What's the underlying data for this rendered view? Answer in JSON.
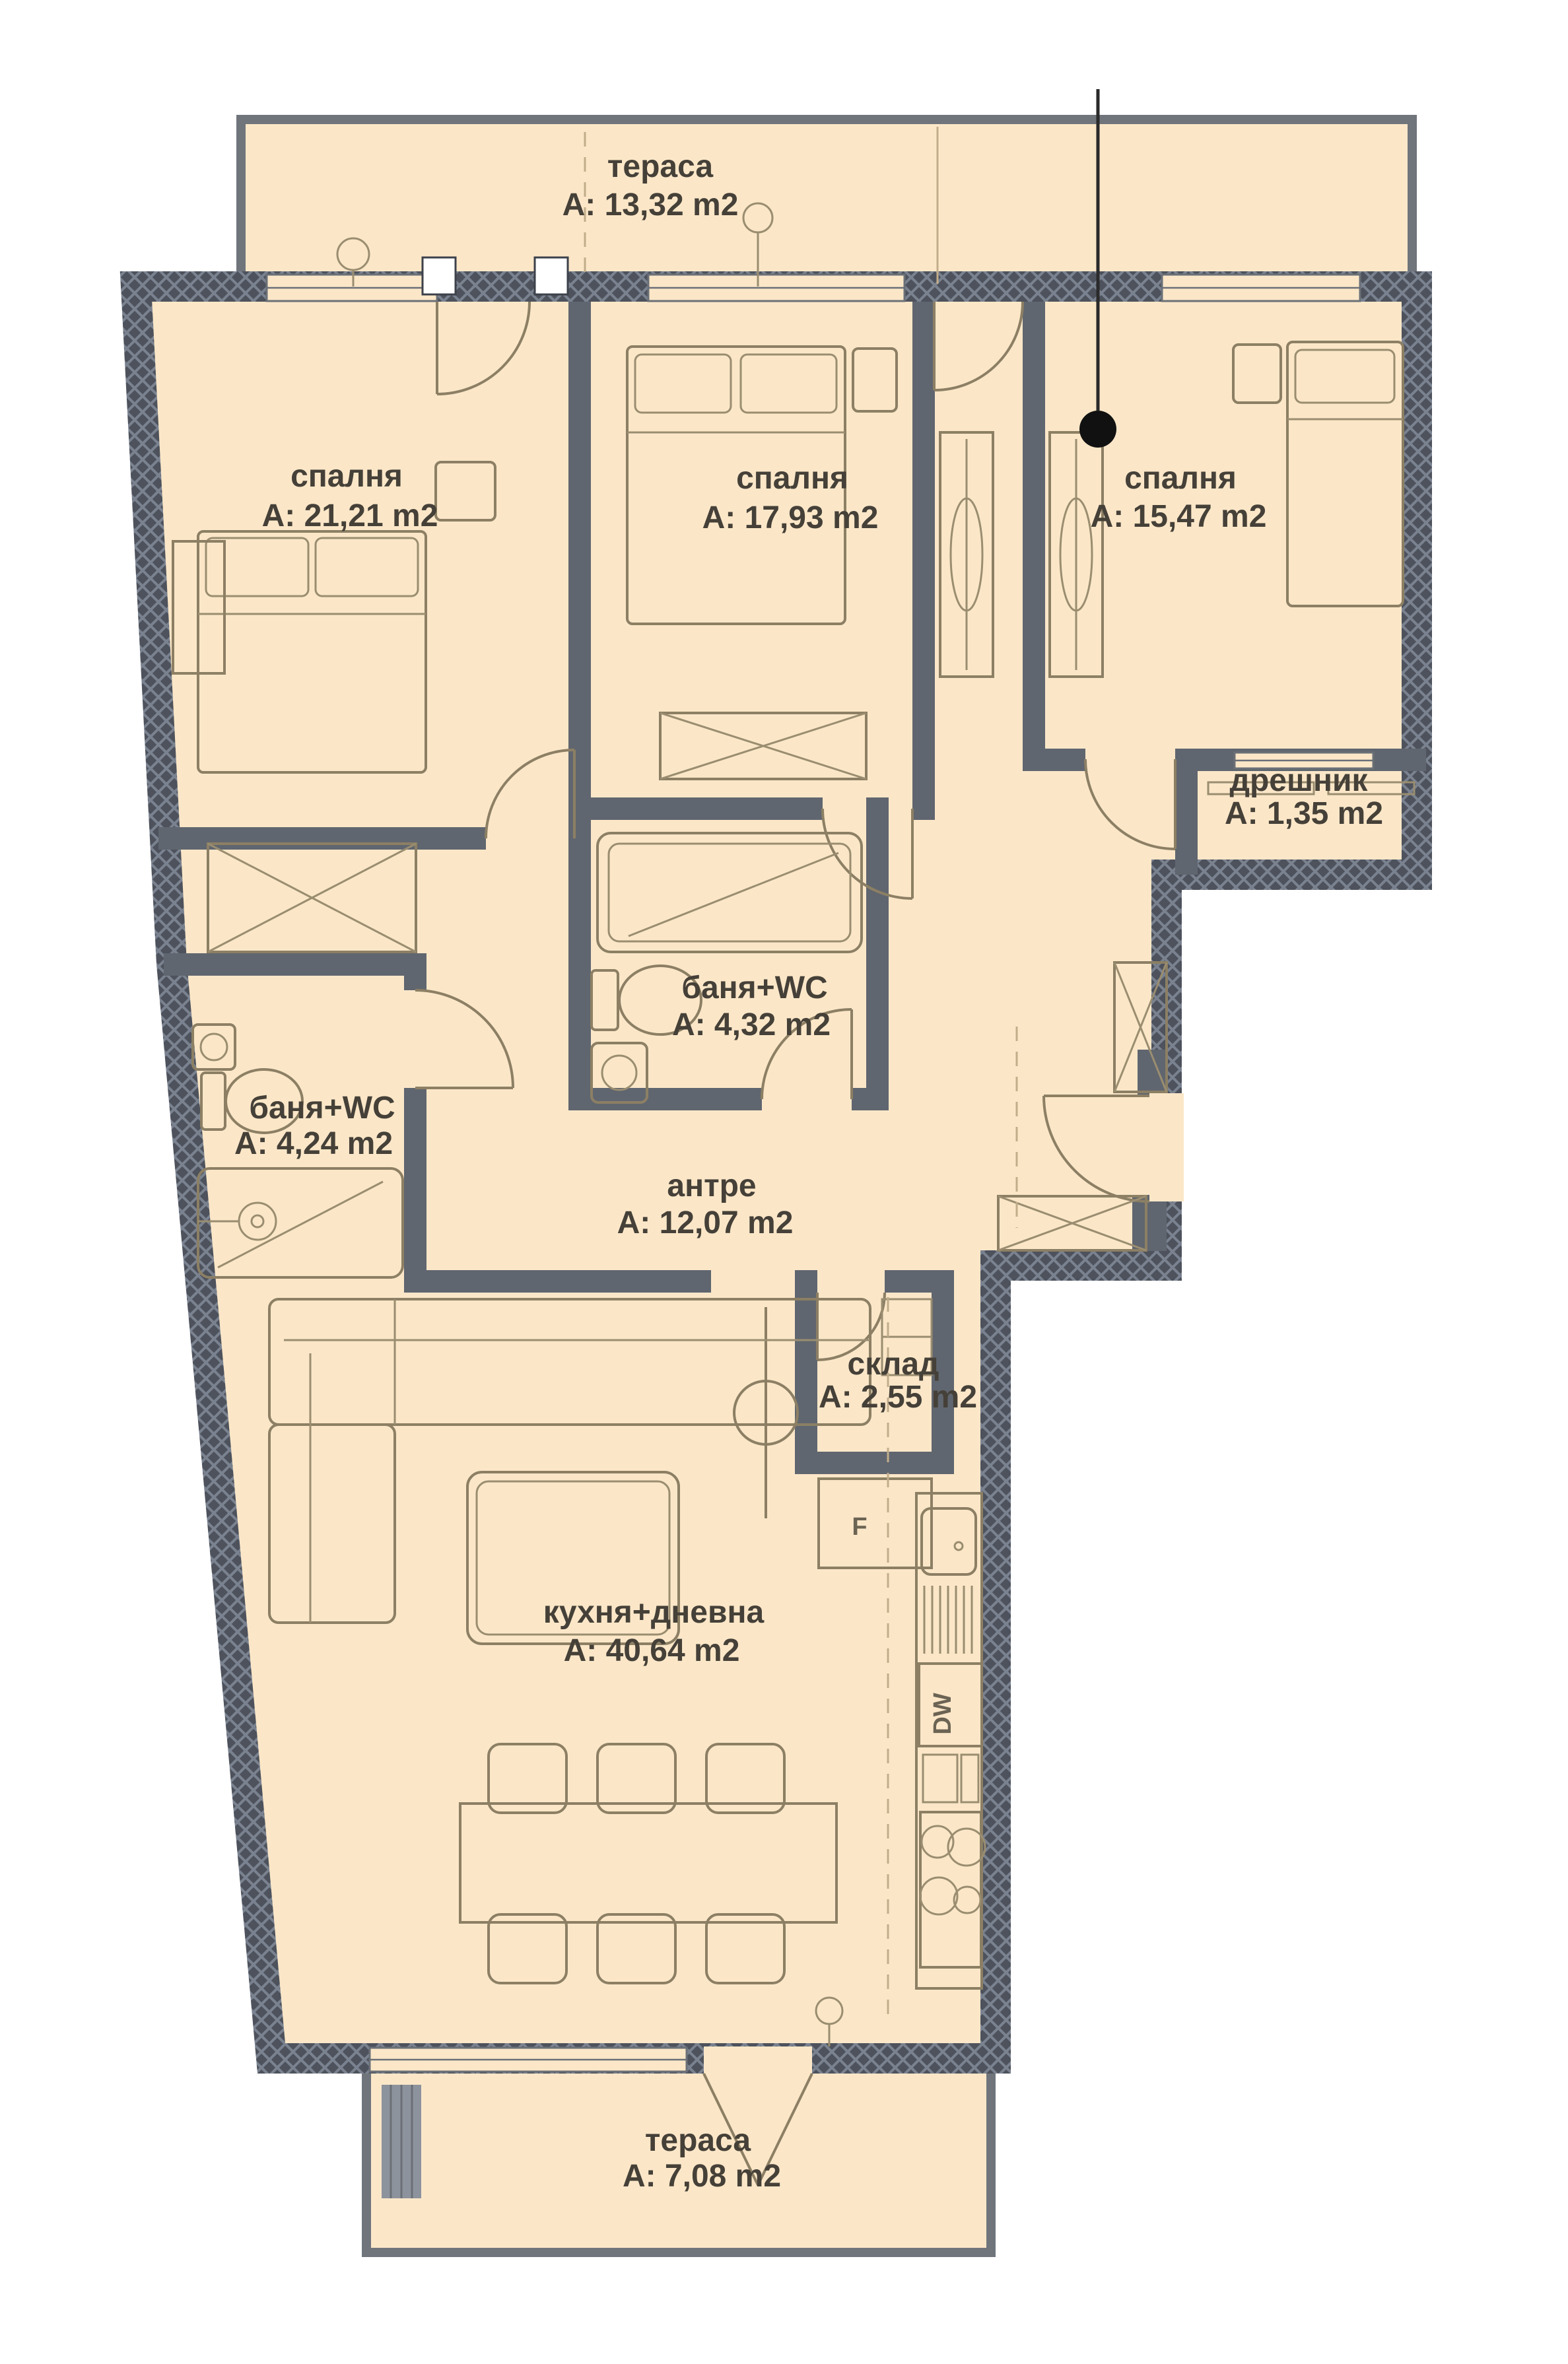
{
  "plan": {
    "rooms": [
      {
        "id": "terrace_top",
        "name": "тераса",
        "area": "A: 13,32 m2"
      },
      {
        "id": "bedroom_left",
        "name": "спалня",
        "area": "A: 21,21 m2"
      },
      {
        "id": "bedroom_middle",
        "name": "спалня",
        "area": "A: 17,93 m2"
      },
      {
        "id": "bedroom_right",
        "name": "спалня",
        "area": "A: 15,47 m2"
      },
      {
        "id": "closet",
        "name": "дрешник",
        "area": "A: 1,35 m2"
      },
      {
        "id": "bathroom_middle",
        "name": "баня+WC",
        "area": "A: 4,32 m2"
      },
      {
        "id": "bathroom_left",
        "name": "баня+WC",
        "area": "A: 4,24 m2"
      },
      {
        "id": "hallway",
        "name": "антре",
        "area": "A: 12,07 m2"
      },
      {
        "id": "storage",
        "name": "склад",
        "area": "A: 2,55 m2"
      },
      {
        "id": "kitchen_living",
        "name": "кухня+дневна",
        "area": "A: 40,64 m2"
      },
      {
        "id": "terrace_bottom",
        "name": "тераса",
        "area": "A: 7,08 m2"
      }
    ],
    "appliances": {
      "dishwasher": "DW",
      "fridge": "F"
    },
    "colors": {
      "floor": "#fbe7c8",
      "exterior_wall": "#4d525c",
      "interior_wall": "#60666f",
      "furniture_line": "#8c7f64",
      "text": "#454038",
      "background": "#ffffff",
      "marker_dot": "#111111"
    }
  }
}
